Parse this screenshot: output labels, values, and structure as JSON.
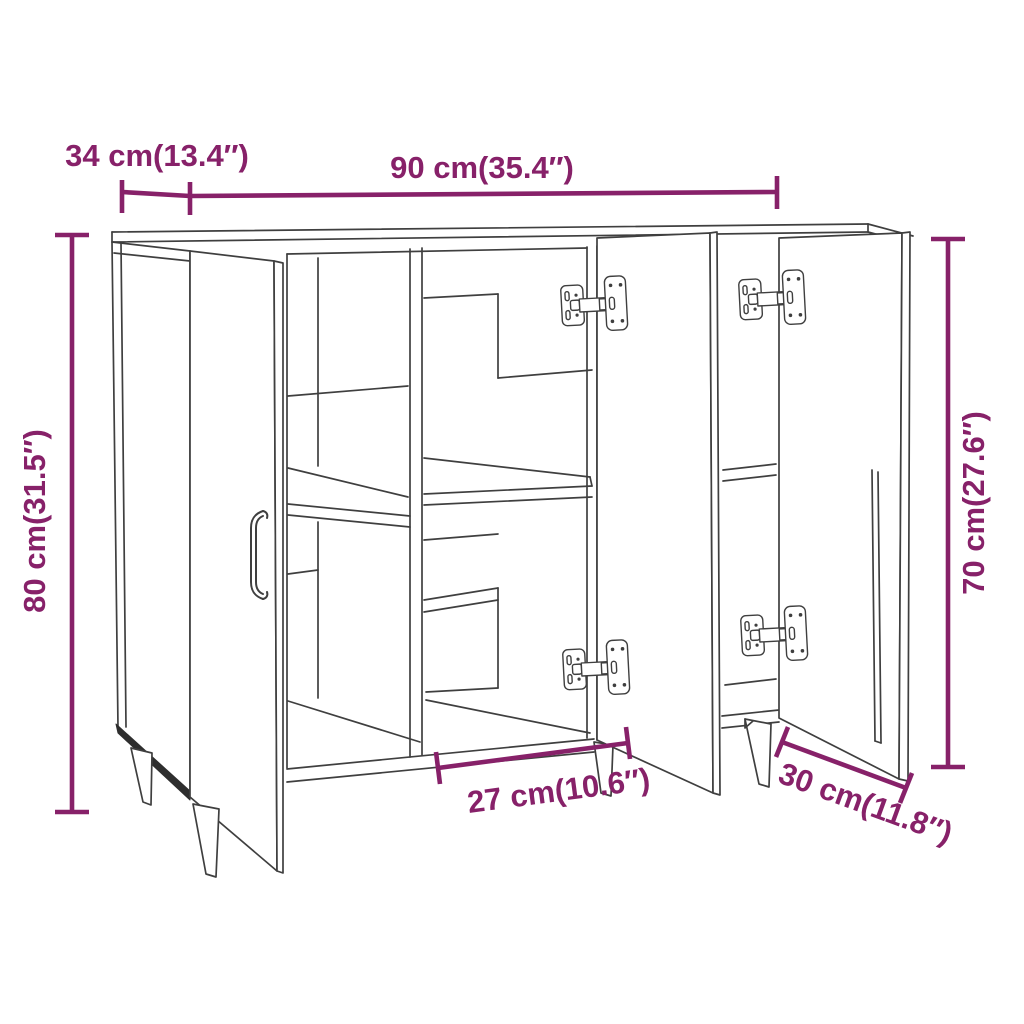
{
  "diagram": {
    "kind": "furniture-dimension-line-drawing",
    "subject": "three-door sideboard with open doors, interior shelves, concealed hinges and splayed legs",
    "colors": {
      "dimension_accent": "#872169",
      "drawing_line": "#3f3f3f",
      "background": "#ffffff"
    },
    "dimensions": {
      "depth": {
        "label": "34 cm(13.4″)",
        "position": "top-left horizontal"
      },
      "width": {
        "label": "90 cm(35.4″)",
        "position": "top horizontal"
      },
      "height": {
        "label": "80 cm(31.5″)",
        "position": "left vertical"
      },
      "door_height": {
        "label": "70 cm(27.6″)",
        "position": "right vertical"
      },
      "inner_width": {
        "label": "27 cm(10.6″)",
        "position": "bottom center diagonal"
      },
      "inner_depth": {
        "label": "30 cm(11.8″)",
        "position": "bottom right diagonal"
      }
    }
  }
}
